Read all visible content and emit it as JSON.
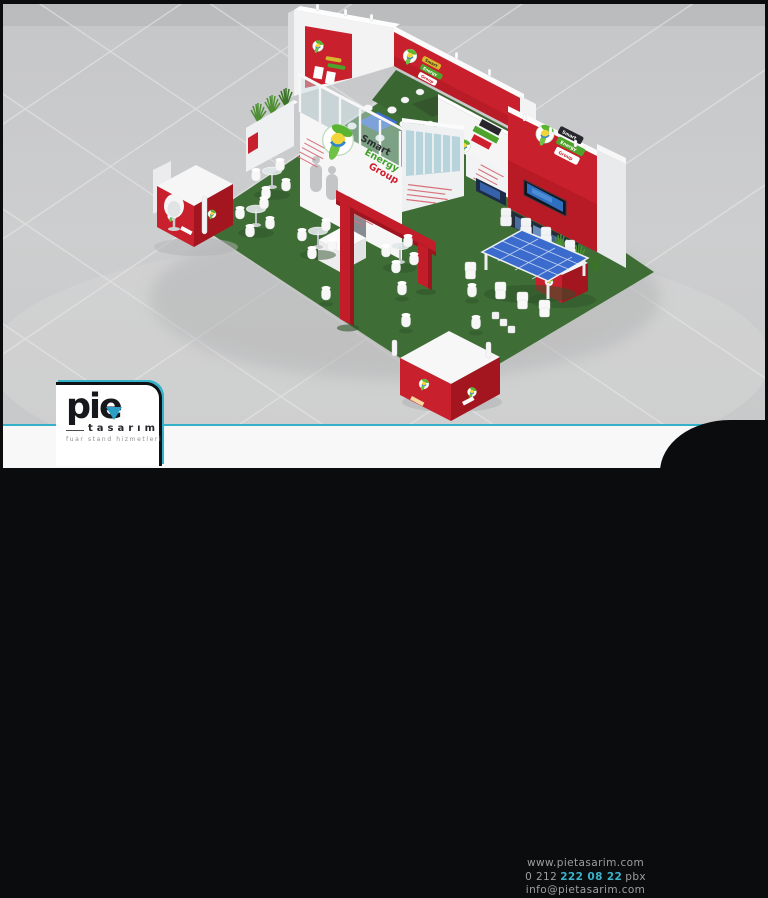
{
  "scene": {
    "brand": {
      "smart": "Smart",
      "energy": "Energy",
      "group": "Group"
    },
    "icons": {
      "brand_logo": "smart-energy-globe-leaf-circle",
      "logo_drop": "teal-down-triangle"
    },
    "colors": {
      "booth_red": "#c8202c",
      "booth_red_shade": "#a3151f",
      "carpet_green": "#3f6d36",
      "accent_teal": "#35b1c9",
      "brand_green": "#3fa12a",
      "brand_dark": "#2b2b31",
      "brand_red": "#cf1f2e",
      "backdrop_gray": "#c9cacb"
    }
  },
  "footer": {
    "logo": {
      "name": "pie",
      "sub": "tasarım",
      "tagline": "fuar stand hizmetleri"
    },
    "contact": {
      "website": "www.pietasarim.com",
      "phone_prefix": "0 212",
      "phone_highlight": "222 08 22",
      "phone_suffix": "pbx",
      "email": "info@pietasarim.com"
    }
  }
}
